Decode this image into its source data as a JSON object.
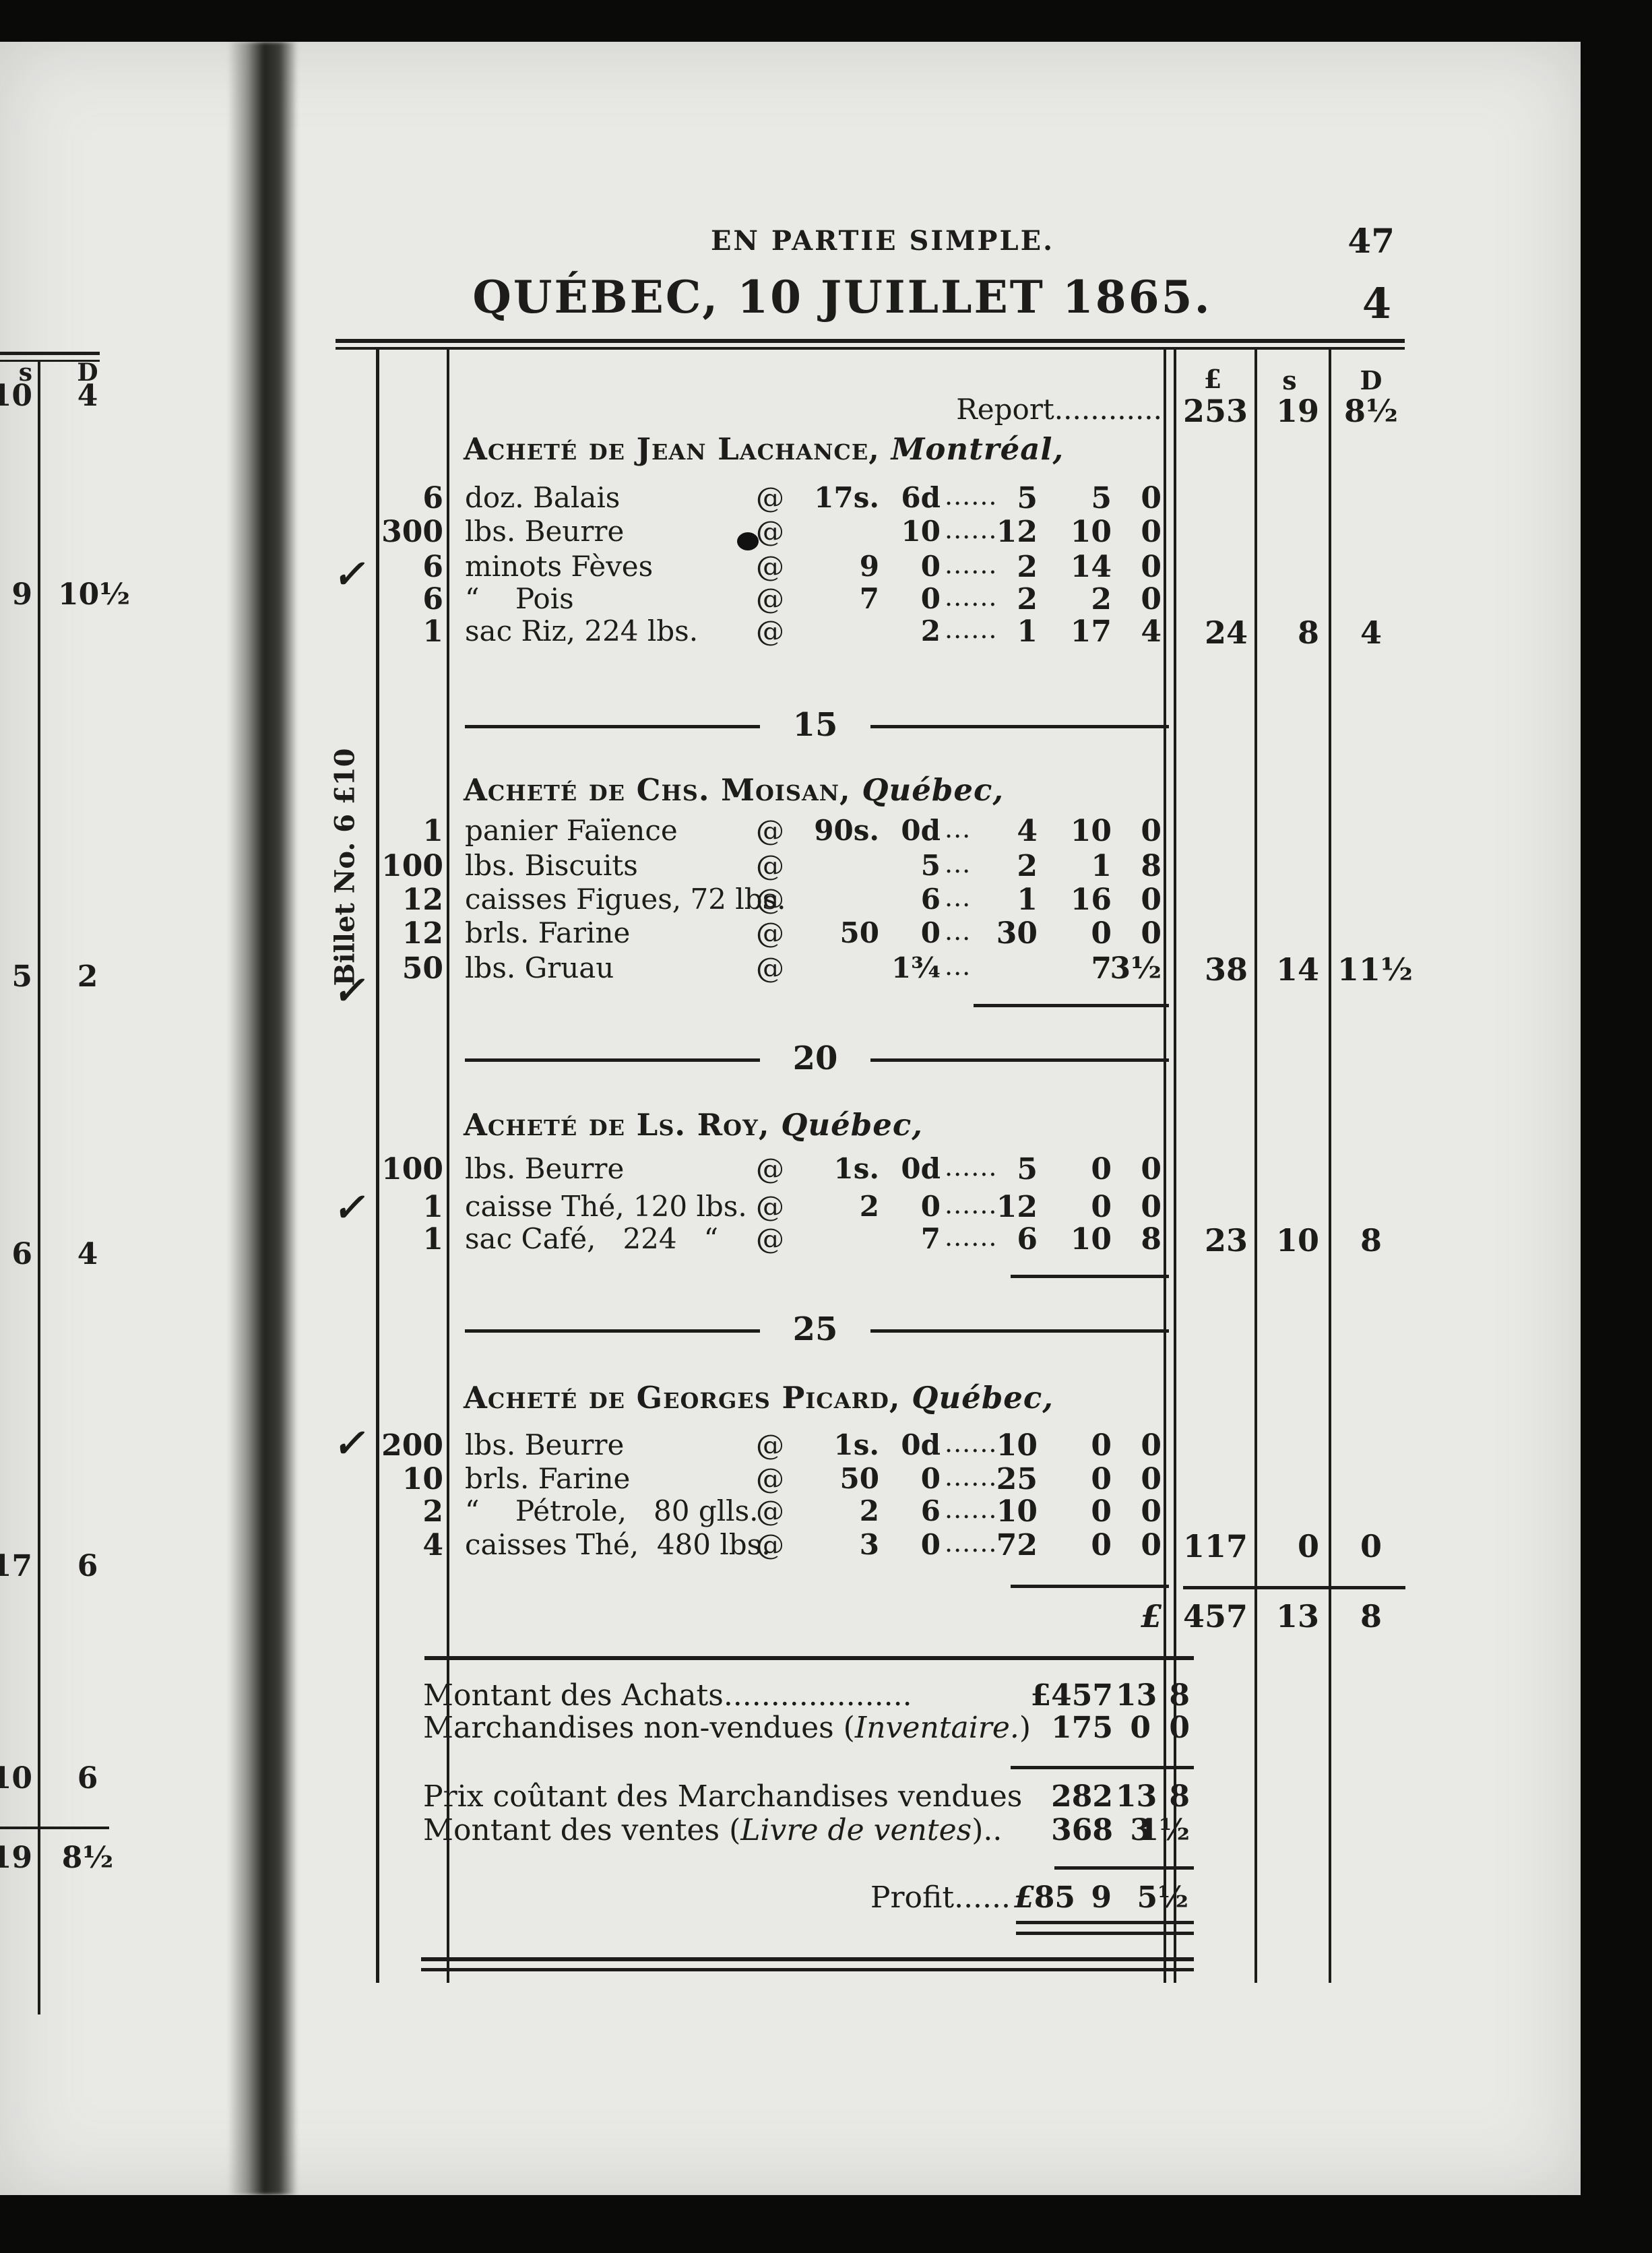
{
  "page": {
    "header": "EN PARTIE SIMPLE.",
    "page_number": "47",
    "title": "QUÉBEC, 10 JUILLET 1865.",
    "folio": "4",
    "margin_note": "Billet No. 6 £10",
    "checkmark": "✓"
  },
  "at_sign": "@",
  "money_headers": {
    "pound": "£",
    "shillings": "s",
    "pence": "D"
  },
  "report": {
    "label": "Report............",
    "pound": "253",
    "shillings": "19",
    "pence": "8½"
  },
  "sections": [
    {
      "vendor": "Acheté de Jean Lachance,",
      "place": "Montréal,",
      "items": [
        {
          "qty": "6",
          "desc": "doz. Balais",
          "rate_s": "17s.",
          "rate_d": "6d",
          "dots": "......",
          "amt_l": "5",
          "amt_s": "5",
          "amt_d": "0"
        },
        {
          "qty": "300",
          "desc": "lbs. Beurre",
          "rate_s": "",
          "rate_d": "10",
          "dots": "......",
          "amt_l": "12",
          "amt_s": "10",
          "amt_d": "0"
        },
        {
          "qty": "6",
          "desc": "minots Fèves",
          "rate_s": "9",
          "rate_d": "0",
          "dots": "......",
          "amt_l": "2",
          "amt_s": "14",
          "amt_d": "0"
        },
        {
          "qty": "6",
          "desc": "“    Pois",
          "rate_s": "7",
          "rate_d": "0",
          "dots": "......",
          "amt_l": "2",
          "amt_s": "2",
          "amt_d": "0"
        },
        {
          "qty": "1",
          "desc": "sac Riz, 224 lbs.",
          "rate_s": "",
          "rate_d": "2",
          "dots": "......",
          "amt_l": "1",
          "amt_s": "17",
          "amt_d": "4"
        }
      ],
      "total": {
        "pound": "24",
        "shillings": "8",
        "pence": "4"
      }
    },
    {
      "divider_before": "15",
      "vendor": "Acheté de Chs. Moisan,",
      "place": "Québec,",
      "items": [
        {
          "qty": "1",
          "desc": "panier Faïence",
          "rate_s": "90s.",
          "rate_d": "0d",
          "dots": "...",
          "amt_l": "4",
          "amt_s": "10",
          "amt_d": "0"
        },
        {
          "qty": "100",
          "desc": "lbs. Biscuits",
          "rate_s": "",
          "rate_d": "5",
          "dots": "...",
          "amt_l": "2",
          "amt_s": "1",
          "amt_d": "8"
        },
        {
          "qty": "12",
          "desc": "caisses Figues, 72 lbs.",
          "rate_s": "",
          "rate_d": "6",
          "dots": "...",
          "amt_l": "1",
          "amt_s": "16",
          "amt_d": "0"
        },
        {
          "qty": "12",
          "desc": "brls. Farine",
          "rate_s": "50",
          "rate_d": "0",
          "dots": "...",
          "amt_l": "30",
          "amt_s": "0",
          "amt_d": "0"
        },
        {
          "qty": "50",
          "desc": "lbs. Gruau",
          "rate_s": "",
          "rate_d": "1¾",
          "dots": "...",
          "amt_l": "",
          "amt_s": "7",
          "amt_d": "3½"
        }
      ],
      "total": {
        "pound": "38",
        "shillings": "14",
        "pence": "11½"
      }
    },
    {
      "divider_before": "20",
      "vendor": "Acheté de Ls. Roy,",
      "place": "Québec,",
      "items": [
        {
          "qty": "100",
          "desc": "lbs. Beurre",
          "rate_s": "1s.",
          "rate_d": "0d",
          "dots": "......",
          "amt_l": "5",
          "amt_s": "0",
          "amt_d": "0"
        },
        {
          "qty": "1",
          "desc": "caisse Thé, 120 lbs.",
          "rate_s": "2",
          "rate_d": "0",
          "dots": "......",
          "amt_l": "12",
          "amt_s": "0",
          "amt_d": "0"
        },
        {
          "qty": "1",
          "desc": "sac Café,   224   “",
          "rate_s": "",
          "rate_d": "7",
          "dots": "......",
          "amt_l": "6",
          "amt_s": "10",
          "amt_d": "8"
        }
      ],
      "total": {
        "pound": "23",
        "shillings": "10",
        "pence": "8"
      }
    },
    {
      "divider_before": "25",
      "vendor": "Acheté de Georges Picard,",
      "place": "Québec,",
      "items": [
        {
          "qty": "200",
          "desc": "lbs. Beurre",
          "rate_s": "1s.",
          "rate_d": "0d",
          "dots": "......",
          "amt_l": "10",
          "amt_s": "0",
          "amt_d": "0"
        },
        {
          "qty": "10",
          "desc": "brls. Farine",
          "rate_s": "50",
          "rate_d": "0",
          "dots": "......",
          "amt_l": "25",
          "amt_s": "0",
          "amt_d": "0"
        },
        {
          "qty": "2",
          "desc": "“    Pétrole,   80 glls.",
          "rate_s": "2",
          "rate_d": "6",
          "dots": "......",
          "amt_l": "10",
          "amt_s": "0",
          "amt_d": "0"
        },
        {
          "qty": "4",
          "desc": "caisses Thé,  480 lbs.",
          "rate_s": "3",
          "rate_d": "0",
          "dots": "......",
          "amt_l": "72",
          "amt_s": "0",
          "amt_d": "0"
        }
      ],
      "total": {
        "pound": "117",
        "shillings": "0",
        "pence": "0"
      }
    }
  ],
  "grand_total": {
    "currency": "£",
    "pound": "457",
    "shillings": "13",
    "pence": "8"
  },
  "summary": {
    "achats": {
      "label": "Montant des Achats....................",
      "pound": "£457",
      "shillings": "13",
      "pence": "8"
    },
    "inventaire": {
      "label_pre": "Marchandises non-vendues (",
      "label_italic": "Inventaire.",
      "label_post": ")",
      "pound": "175",
      "shillings": "0",
      "pence": "0"
    },
    "cout": {
      "label": "Prix coûtant des Marchandises vendues",
      "pound": "282",
      "shillings": "13",
      "pence": "8"
    },
    "ventes": {
      "label_pre": "Montant des ventes (",
      "label_italic": "Livre de ventes",
      "label_post": ")..",
      "pound": "368",
      "shillings": "3",
      "pence": "1½"
    },
    "profit": {
      "label": "Profit......",
      "currency": "£",
      "pound": "85",
      "shillings": "9",
      "pence": "5½"
    }
  },
  "left_fragment": {
    "shillings_header": "s",
    "pence_header": "D",
    "rows": [
      {
        "s": "10",
        "d": "4"
      },
      {
        "s": "9",
        "d": "10½"
      },
      {
        "s": "5",
        "d": "2"
      },
      {
        "s": "6",
        "d": "4"
      },
      {
        "s": "17",
        "d": "6"
      },
      {
        "s": "10",
        "d": "6"
      },
      {
        "s": "19",
        "d": "8½"
      }
    ]
  }
}
